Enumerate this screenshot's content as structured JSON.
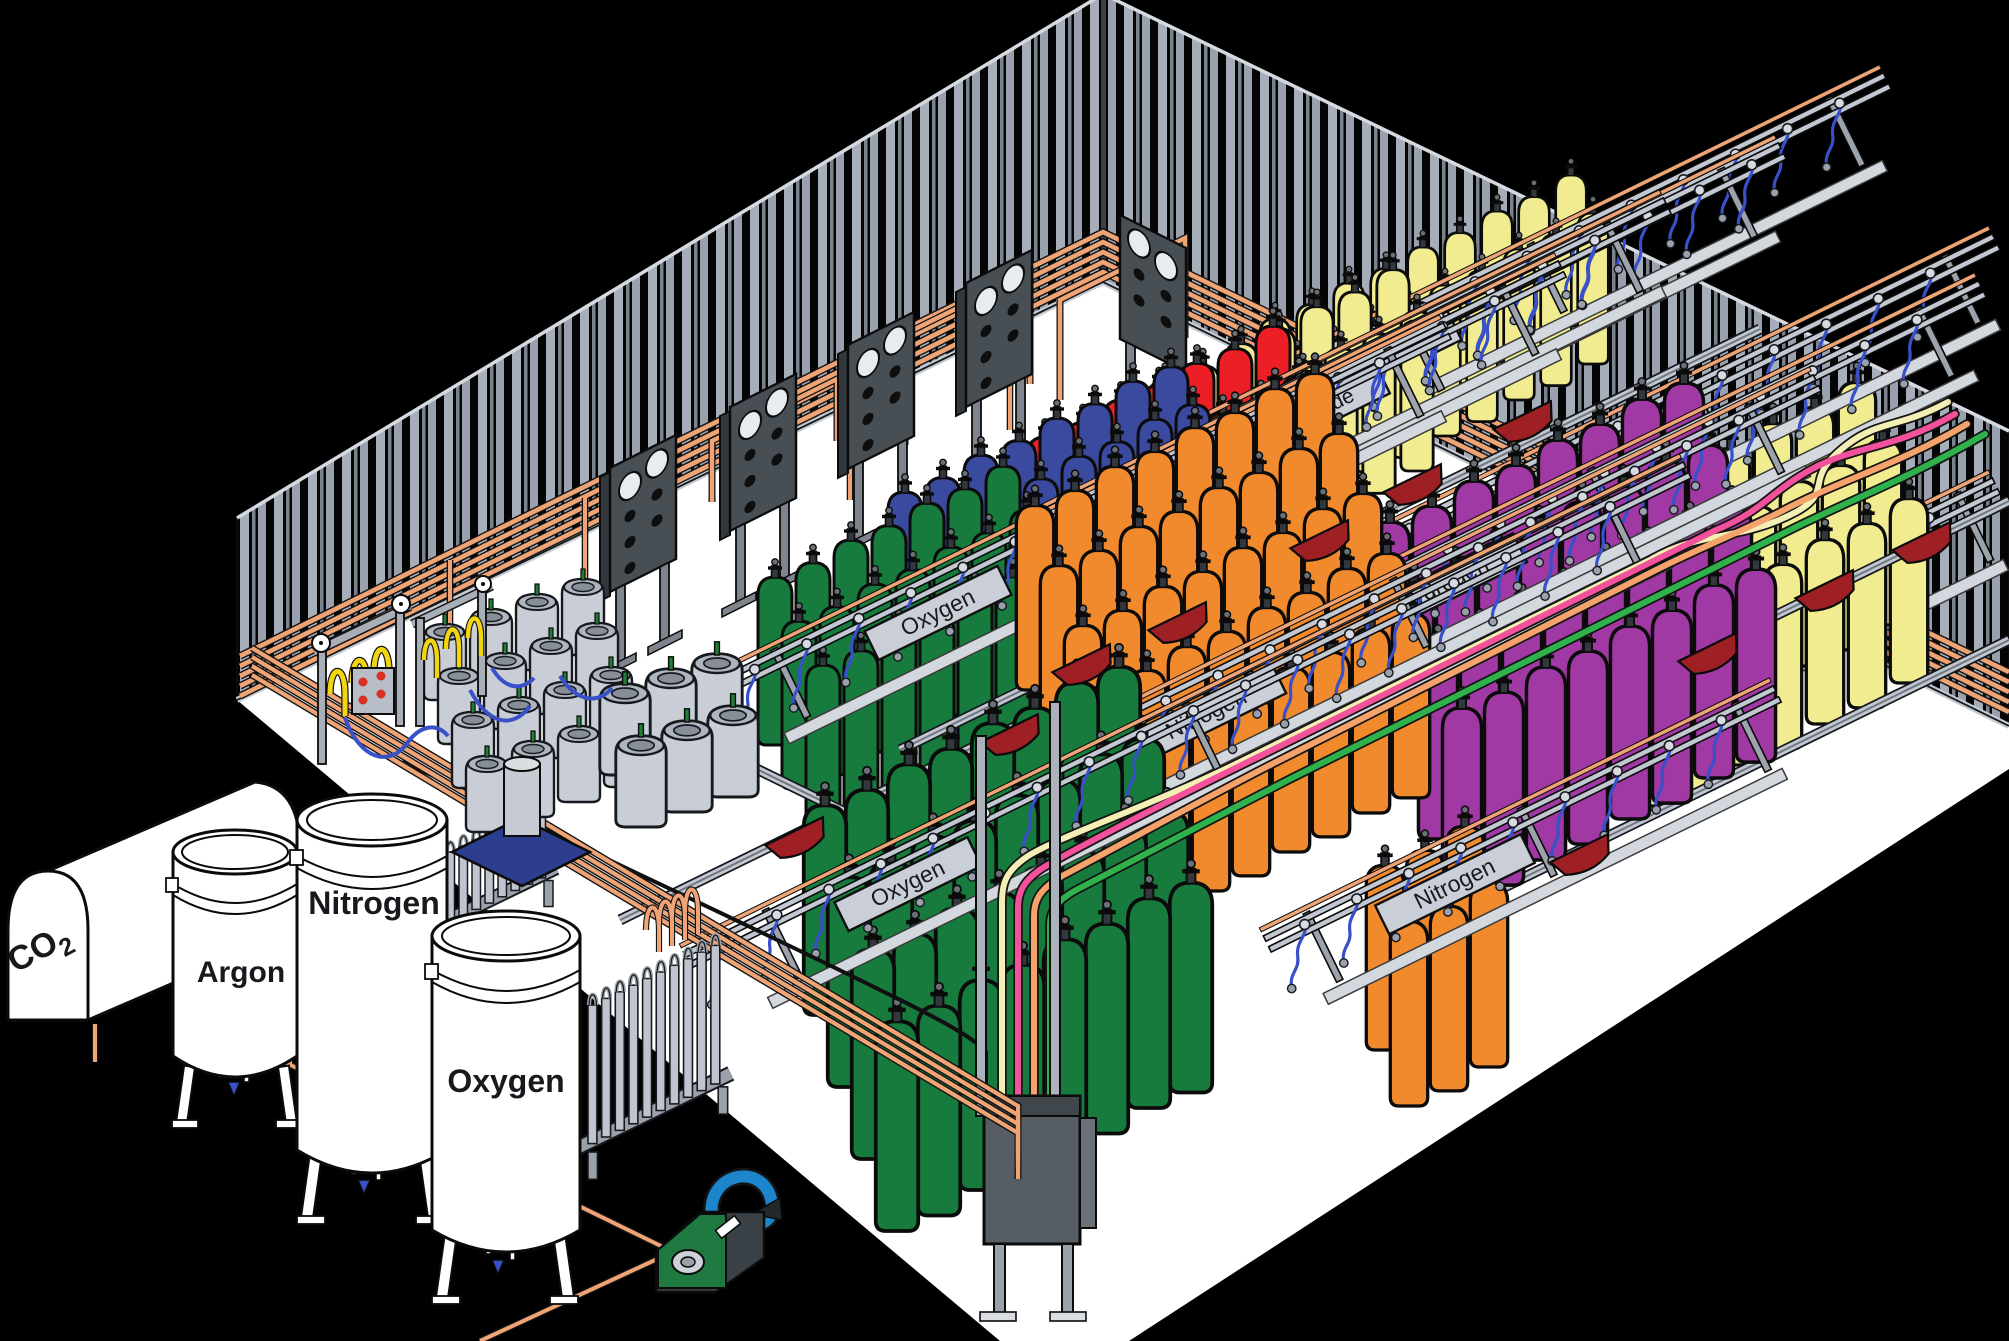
{
  "colors": {
    "bg": "#000000",
    "floor": "#ffffff",
    "wall_light": "#a6aeba",
    "wall_mid": "#7a828e",
    "wall_light2": "#98a1ad",
    "edge_light": "#d5dae0",
    "skirt": "#c3c9d1",
    "copper": "#efa475",
    "rail": "#c2c8d2",
    "rail_dark": "#70777f",
    "plaque": "#c9ced7",
    "panel": "#474e54",
    "panel_side": "#31373c",
    "post_gray": "#a8afb9",
    "cart_red": "#9e1f24",
    "hose_blue": "#3850c8",
    "pigtail_yellow": "#f3d410",
    "indicator_red": "#d93025",
    "gauge_white": "#ffffff",
    "dewar_gray": "#c9ced6",
    "dewar_rim": "#aeb5be",
    "valve_green": "#1f7f35",
    "skid_blue": "#2e3e8e",
    "comp_green": "#1e7a41",
    "comp_blue": "#1c85cc",
    "line_cream": "#f4efb5",
    "line_pink": "#f2519b",
    "line_salmon": "#f5a26b",
    "line_green": "#2fb14c",
    "cyl_green": "#177b3d",
    "cyl_blue": "#3a4a9f",
    "cyl_red": "#ec1f26",
    "cyl_yellow": "#f1ec8f",
    "cyl_purple": "#a039a3",
    "cyl_orange": "#f18a2d",
    "tank_white": "#ffffff"
  },
  "storage_tanks": {
    "co2": {
      "label_main": "CO",
      "label_sub": "2"
    },
    "argon": {
      "label": "Argon"
    },
    "nitrogen": {
      "label": "Nitrogen"
    },
    "oxygen": {
      "label": "Oxygen"
    }
  },
  "racks": [
    {
      "label": "Oxygen",
      "x1": 730,
      "y1": 715,
      "x2": 1460,
      "y2": 357,
      "pw": 148,
      "t": 0.285,
      "fs": 23
    },
    {
      "label": "Nitrogen",
      "x1": 845,
      "y1": 653,
      "x2": 1575,
      "y2": 295,
      "pw": 162,
      "t": 0.301,
      "fs": 23
    },
    {
      "label": "Helium",
      "x1": 945,
      "y1": 592,
      "x2": 1680,
      "y2": 232,
      "pw": 146,
      "t": 0.302,
      "fs": 23
    },
    {
      "label": "Carbon Dioxide",
      "x1": 1050,
      "y1": 542,
      "x2": 1795,
      "y2": 177,
      "pw": 212,
      "t": 0.319,
      "fs": 21
    },
    {
      "label": "Argon",
      "x1": 1190,
      "y1": 455,
      "x2": 1900,
      "y2": 107,
      "pw": 132,
      "t": 0.289,
      "fs": 23
    },
    {
      "label": "Argon",
      "x1": 1385,
      "y1": 574,
      "x2": 2009,
      "y2": 268,
      "pw": 150,
      "t": 0.412,
      "fs": 23
    },
    {
      "label": "",
      "x1": 1540,
      "y1": 742,
      "x2": 2009,
      "y2": 512,
      "pw": 0,
      "t": 0.5,
      "fs": 23
    },
    {
      "label": "Hydrogen",
      "x1": 1215,
      "y1": 697,
      "x2": 1995,
      "y2": 315,
      "pw": 172,
      "t": 0.292,
      "fs": 23
    },
    {
      "label": "Nitrogen",
      "x1": 985,
      "y1": 823,
      "x2": 1830,
      "y2": 409,
      "pw": 162,
      "t": 0.262,
      "fs": 23
    },
    {
      "label": "Nitrogen",
      "x1": 1280,
      "y1": 970,
      "x2": 1790,
      "y2": 720,
      "pw": 162,
      "t": 0.343,
      "fs": 23
    },
    {
      "label": "Oxygen",
      "x1": 700,
      "y1": 986,
      "x2": 1700,
      "y2": 496,
      "pw": 148,
      "t": 0.208,
      "fs": 23
    }
  ],
  "cylinder_groups": [
    {
      "gas": "oxygen",
      "color": "cyl_green",
      "x": 775,
      "y": 745,
      "cols": 7,
      "rows": 3,
      "csx": 38,
      "csy": -18.5,
      "rsx": 24,
      "rsy": 44,
      "s": 1.0
    },
    {
      "gas": "nitrogen",
      "color": "cyl_blue",
      "x": 905,
      "y": 660,
      "cols": 8,
      "rows": 3,
      "csx": 38,
      "csy": -18.5,
      "rsx": 22,
      "rsy": 38,
      "s": 1.0
    },
    {
      "gas": "helium",
      "color": "cyl_red",
      "x": 1045,
      "y": 605,
      "cols": 7,
      "rows": 3,
      "csx": 38,
      "csy": -18.5,
      "rsx": 26,
      "rsy": 50,
      "s": 1.0
    },
    {
      "gas": "carbon-dioxide",
      "color": "cyl_yellow",
      "x": 1165,
      "y": 540,
      "cols": 7,
      "rows": 2,
      "csx": 38,
      "csy": -18.5,
      "rsx": 24,
      "rsy": 42,
      "s": 0.95
    },
    {
      "gas": "argon",
      "color": "cyl_yellow",
      "x": 1275,
      "y": 470,
      "cols": 9,
      "rows": 2,
      "csx": 37,
      "csy": -18,
      "rsx": 22,
      "rsy": 38,
      "s": 0.9
    },
    {
      "gas": "argon",
      "color": "cyl_yellow",
      "x": 1605,
      "y": 690,
      "cols": 7,
      "rows": 3,
      "csx": 42,
      "csy": -20.5,
      "rsx": 26,
      "rsy": 58,
      "s": 1.1
    },
    {
      "gas": "hydrogen",
      "color": "cyl_purple",
      "x": 1390,
      "y": 715,
      "cols": 8,
      "rows": 4,
      "csx": 42,
      "csy": -20.5,
      "rsx": 24,
      "rsy": 62,
      "s": 1.15
    },
    {
      "gas": "nitrogen",
      "color": "cyl_orange",
      "x": 1035,
      "y": 690,
      "cols": 8,
      "rows": 5,
      "csx": 40,
      "csy": -19.5,
      "rsx": 24,
      "rsy": 60,
      "s": 1.1
    },
    {
      "gas": "nitrogen",
      "color": "cyl_orange",
      "x": 1385,
      "y": 1050,
      "cols": 3,
      "rows": 2,
      "csx": 40,
      "csy": -19.5,
      "rsx": 24,
      "rsy": 56,
      "s": 1.1
    },
    {
      "gas": "oxygen",
      "color": "cyl_green",
      "x": 825,
      "y": 1015,
      "cols": 8,
      "rows": 4,
      "csx": 42,
      "csy": -20.5,
      "rsx": 24,
      "rsy": 72,
      "s": 1.25
    }
  ],
  "dewar_clusters": [
    {
      "x": 445,
      "y": 700,
      "cols": 4,
      "rows": 4,
      "csx": 46,
      "csy": -15,
      "rsx": 14,
      "rsy": 44,
      "s": 1.0
    },
    {
      "x": 625,
      "y": 775,
      "cols": 3,
      "rows": 2,
      "csx": 46,
      "csy": -15,
      "rsx": 16,
      "rsy": 52,
      "s": 1.2
    }
  ],
  "manifold_panels": {
    "left": [
      [
        610,
        468
      ],
      [
        730,
        407
      ],
      [
        848,
        345
      ],
      [
        966,
        283
      ]
    ],
    "right": [
      [
        1120,
        215
      ]
    ]
  },
  "vaporizers": [
    {
      "x": 446,
      "y": 852,
      "fins": 8,
      "h": 70,
      "s": 1.0
    },
    {
      "x": 588,
      "y": 1005,
      "fins": 10,
      "h": 132,
      "s": 1.05
    }
  ],
  "carts": [
    {
      "x": 795,
      "y": 833
    },
    {
      "x": 1010,
      "y": 730
    },
    {
      "x": 1082,
      "y": 660
    },
    {
      "x": 1178,
      "y": 618
    },
    {
      "x": 1320,
      "y": 536
    },
    {
      "x": 1413,
      "y": 480
    },
    {
      "x": 1523,
      "y": 417
    },
    {
      "x": 1708,
      "y": 649
    },
    {
      "x": 1825,
      "y": 586
    },
    {
      "x": 1922,
      "y": 538
    },
    {
      "x": 1580,
      "y": 850
    }
  ]
}
